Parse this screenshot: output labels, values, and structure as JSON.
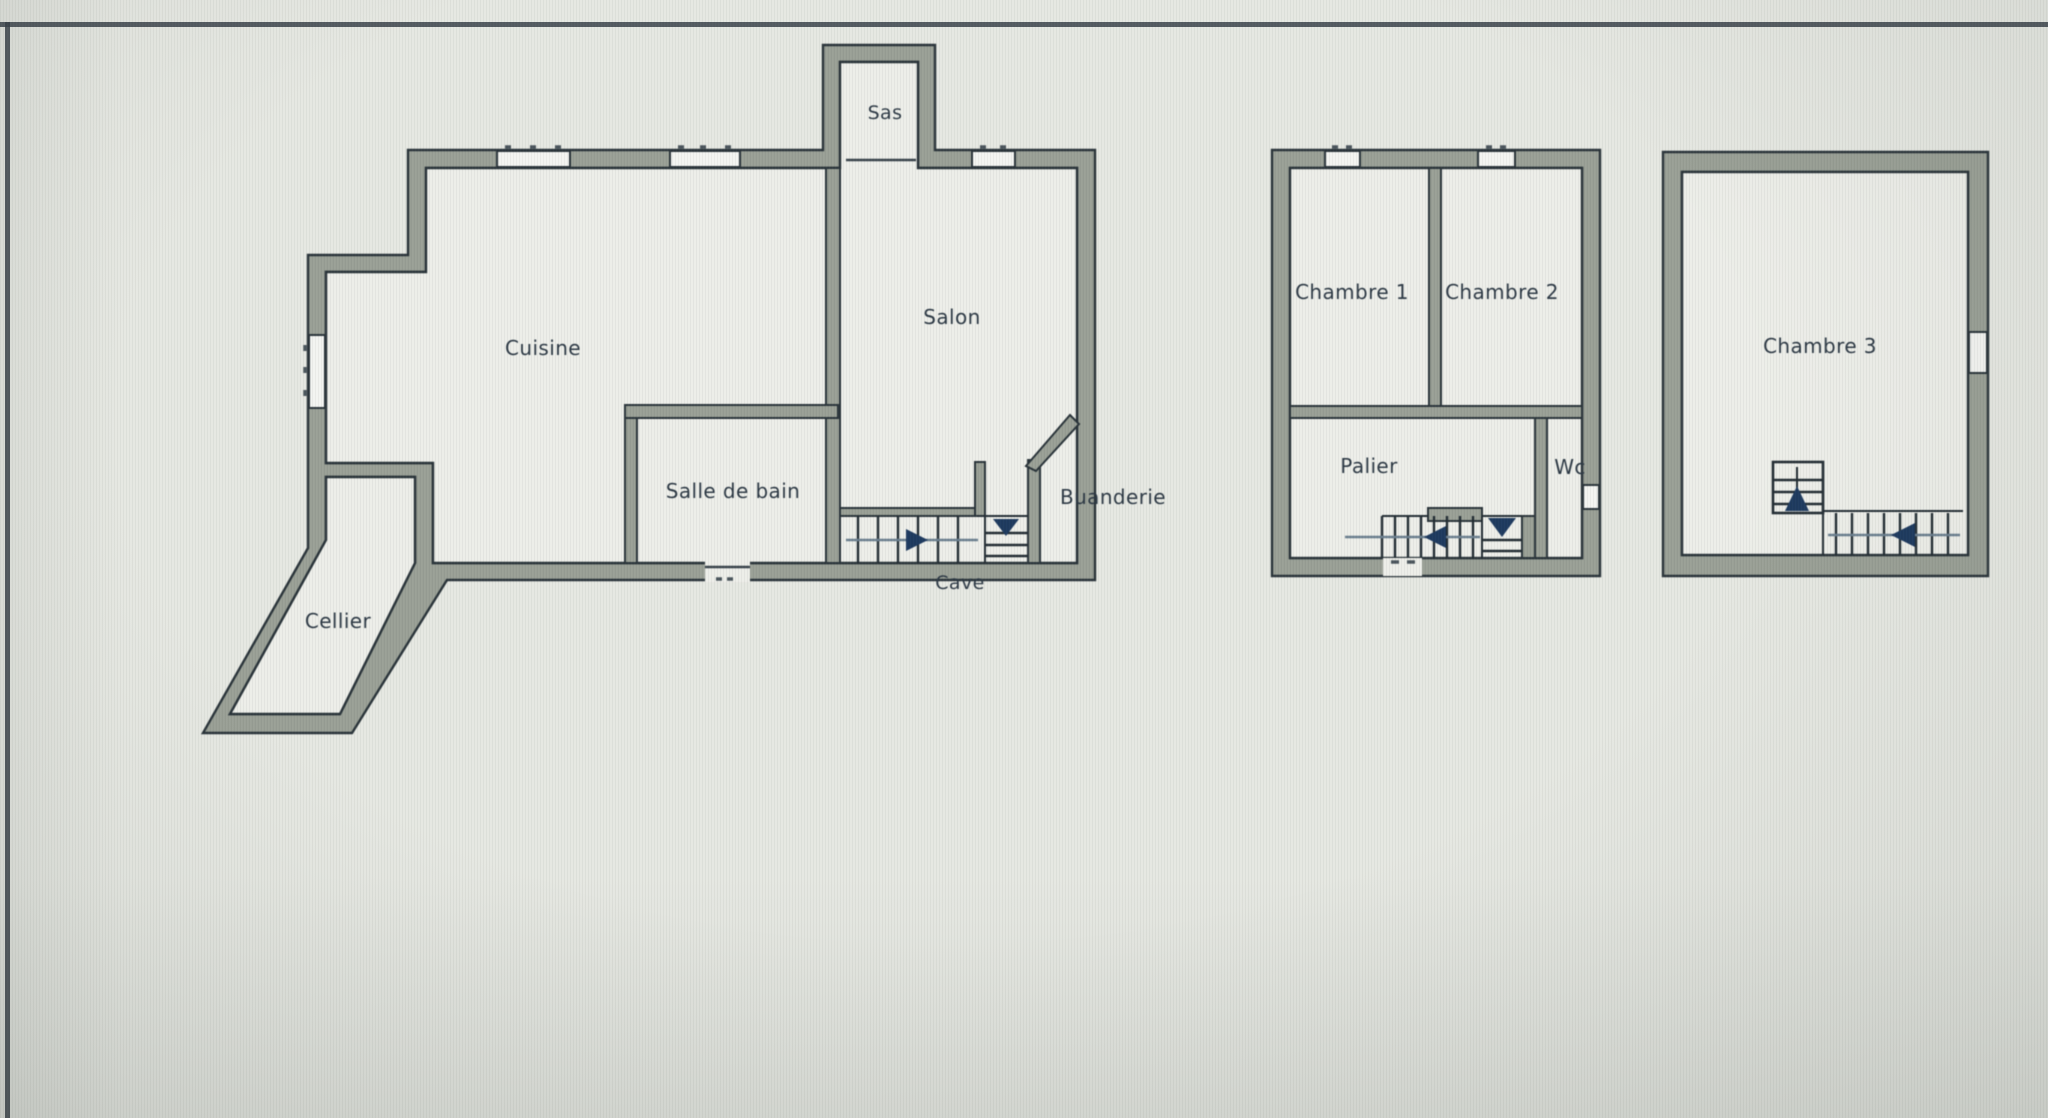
{
  "document": {
    "type": "floor-plan-drawing",
    "levels": [
      "ground-floor",
      "first-floor",
      "second-floor"
    ]
  },
  "colors": {
    "background": "#e6e8e2",
    "floor": "#edeee9",
    "wall_fill": "#9aa096",
    "wall_outline": "#2a343a",
    "label_text": "#2d3945",
    "stair_arrow_navy": "#1e3a5f",
    "frame_line": "#39424a"
  },
  "plans": [
    {
      "id": "ground-floor",
      "rooms": [
        {
          "label": "Sas"
        },
        {
          "label": "Cuisine"
        },
        {
          "label": "Salon"
        },
        {
          "label": "Salle de bain"
        },
        {
          "label": "Buanderie"
        },
        {
          "label": "Cave"
        },
        {
          "label": "Cellier"
        }
      ]
    },
    {
      "id": "first-floor",
      "rooms": [
        {
          "label": "Chambre 1"
        },
        {
          "label": "Chambre 2"
        },
        {
          "label": "Palier"
        },
        {
          "label": "Wc"
        }
      ]
    },
    {
      "id": "second-floor",
      "rooms": [
        {
          "label": "Chambre 3"
        }
      ]
    }
  ]
}
